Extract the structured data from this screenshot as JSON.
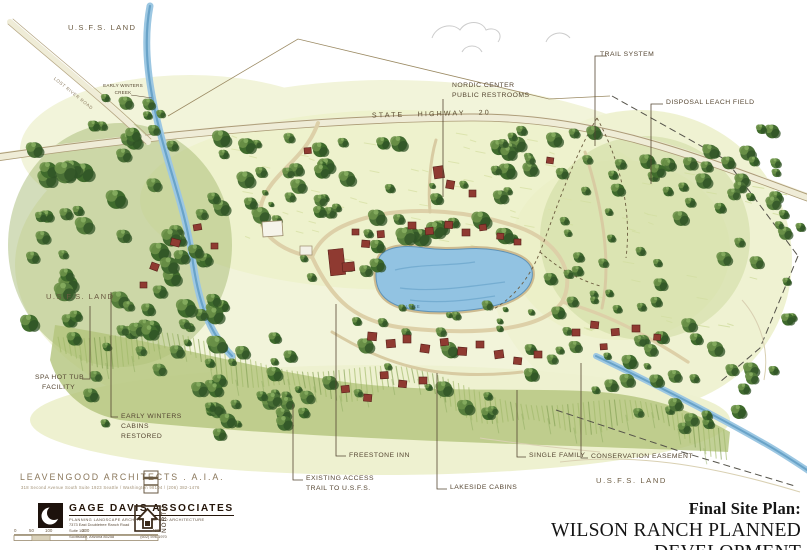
{
  "labels": {
    "usfs_top": "U.S.F.S. LAND",
    "creek": "EARLY WINTERS\nCREEK",
    "road": "LOST RIVER ROAD",
    "nordic": "NORDIC CENTER\nPUBLIC RESTROOMS",
    "highway": "STATE HIGHWAY 20",
    "trail_system": "TRAIL SYSTEM",
    "disposal": "DISPOSAL LEACH FIELD",
    "usfs_left": "U.S.F.S. LAND",
    "spa": "SPA HOT TUB\n   FACILITY",
    "early_winters": "EARLY WINTERS\nCABINS\nRESTORED",
    "freestone": "FREESTONE INN",
    "existing_access": "EXISTING ACCESS\nTRAIL TO U.S.F.S.",
    "lakeside": "LAKESIDE CABINS",
    "single_family": "SINGLE FAMILY",
    "conservation": "CONSERVATION EASEMENT",
    "usfs_bottom": "U.S.F.S. LAND",
    "lake": "LAKE"
  },
  "credits": {
    "leavengood_name": "LEAVENGOOD ARCHITECTS . A.I.A.",
    "leavengood_address": "318 Second Avenue South   Suite 1923   Seattle / Washington 98104 / (206) 382-1476",
    "gage_name": "GAGE DAVIS ASSOCIATES",
    "gage_tagline": "PLANNING LANDSCAPE ARCHITECTURE AND ARCHITECTURE",
    "gage_address1": "7373 East Doubletree Ranch Road",
    "gage_address2": "Suite 100",
    "gage_address3": "Scottsdale, Arizona 85258",
    "gage_phone": "(602) 596-1970",
    "north": "NORTH"
  },
  "scale_bar": {
    "ticks": [
      "0",
      "50",
      "100",
      "200",
      "400"
    ]
  },
  "title_block": {
    "subtitle": "Final Site Plan:",
    "title": "WILSON RANCH PLANNED DEVELOPMENT"
  },
  "colors": {
    "label_ink": "#564733",
    "meadow": "#f1f3d8",
    "forest": "#4a7036",
    "water": "#92c3e2",
    "building": "#8f3a31",
    "title_ink": "#151515"
  }
}
